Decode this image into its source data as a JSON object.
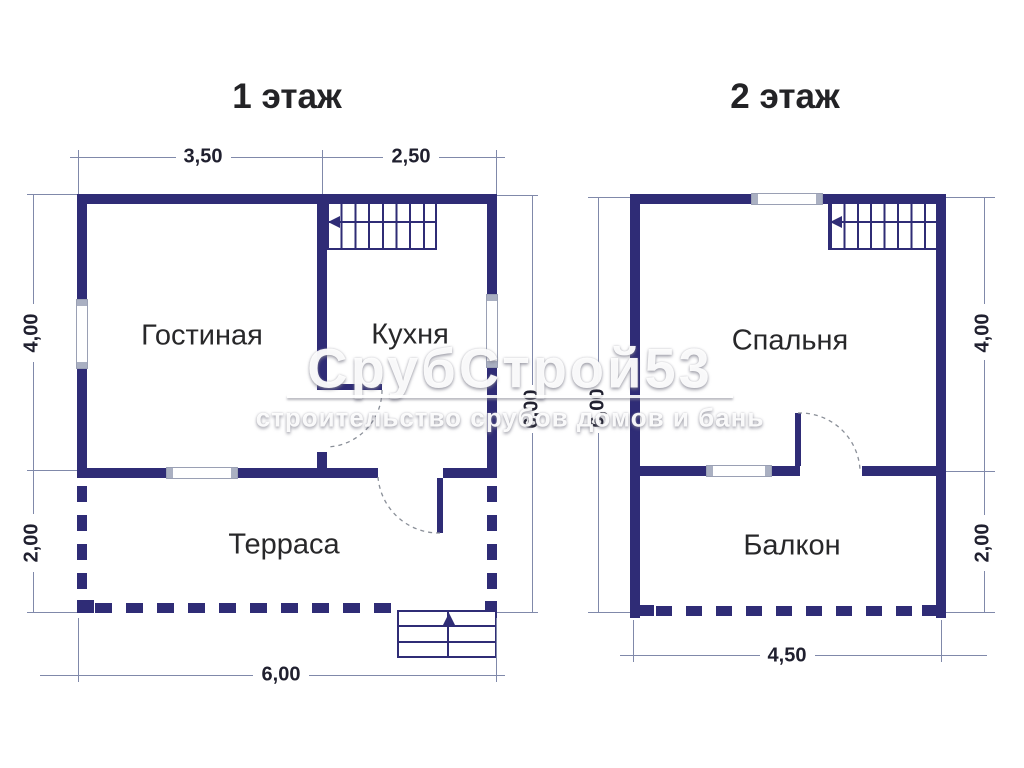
{
  "floor1": {
    "title": "1 этаж",
    "rooms": {
      "living": "Гостиная",
      "kitchen": "Кухня",
      "terrace": "Терраса"
    },
    "dims": {
      "top_left": "3,50",
      "top_right": "2,50",
      "left_upper": "4,00",
      "left_lower": "2,00",
      "right_total": "6,00",
      "bottom_total": "6,00"
    }
  },
  "floor2": {
    "title": "2 этаж",
    "rooms": {
      "bedroom": "Спальня",
      "balcony": "Балкон"
    },
    "dims": {
      "left_total": "6,00",
      "right_upper": "4,00",
      "right_lower": "2,00",
      "bottom_total": "4,50"
    }
  },
  "watermark": {
    "brand": "СрубСтрой53",
    "tagline": "строительство срубов домов и бань"
  },
  "colors": {
    "wall": "#2f2c76",
    "dim_line": "#8089aa",
    "text": "#232326"
  }
}
